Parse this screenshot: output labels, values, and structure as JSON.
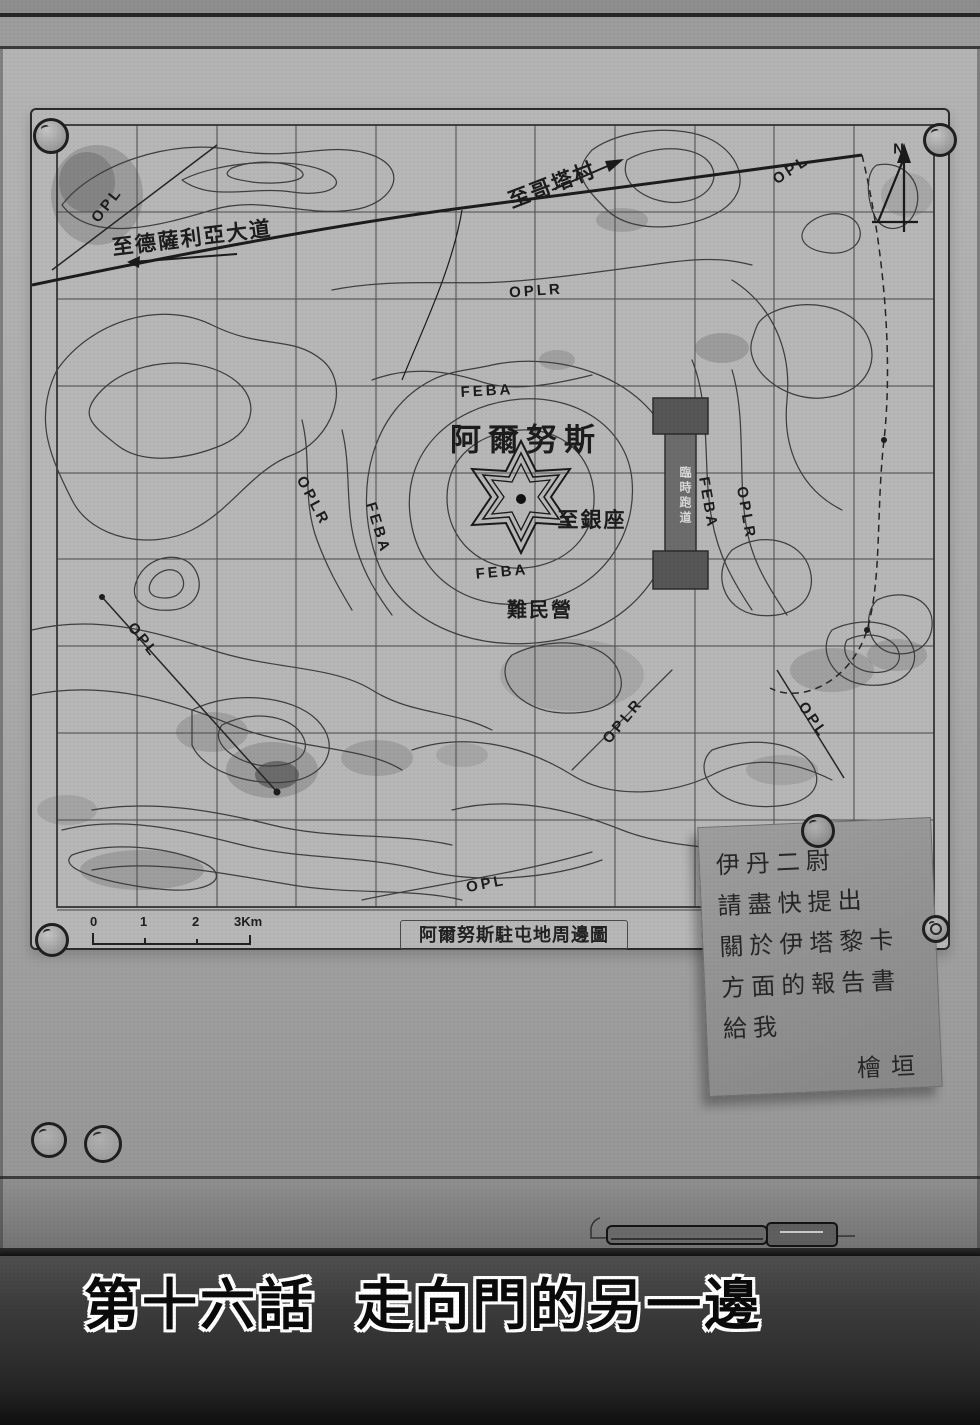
{
  "page": {
    "chapter_title": "第十六話 走向門的另一邊"
  },
  "map": {
    "caption": "阿爾努斯駐屯地周邊圖",
    "north_label": "N",
    "place_labels": {
      "center_name": "阿爾努斯",
      "to_ginza": "至銀座",
      "refugee_camp": "難民營",
      "to_coda_village": "至哥塔村",
      "to_dessalia_road": "至德薩利亞大道",
      "runway": "臨時跑道"
    },
    "line_labels": {
      "opl": "OPL",
      "oplr": "OPLR",
      "feba": "FEBA"
    },
    "scale_ticks": [
      "0",
      "1",
      "2",
      "3Km"
    ]
  },
  "note": {
    "lines": [
      "伊丹二尉",
      "請盡快提出",
      "關於伊塔黎卡",
      "方面的報告書",
      "給我"
    ],
    "signature": "檜垣"
  },
  "colors": {
    "board": "#aaaaaa",
    "map_sheet": "#b7b7b7",
    "ink": "#2a2a2a",
    "title_fill": "#0a0a0a",
    "title_outline": "#ffffff"
  }
}
